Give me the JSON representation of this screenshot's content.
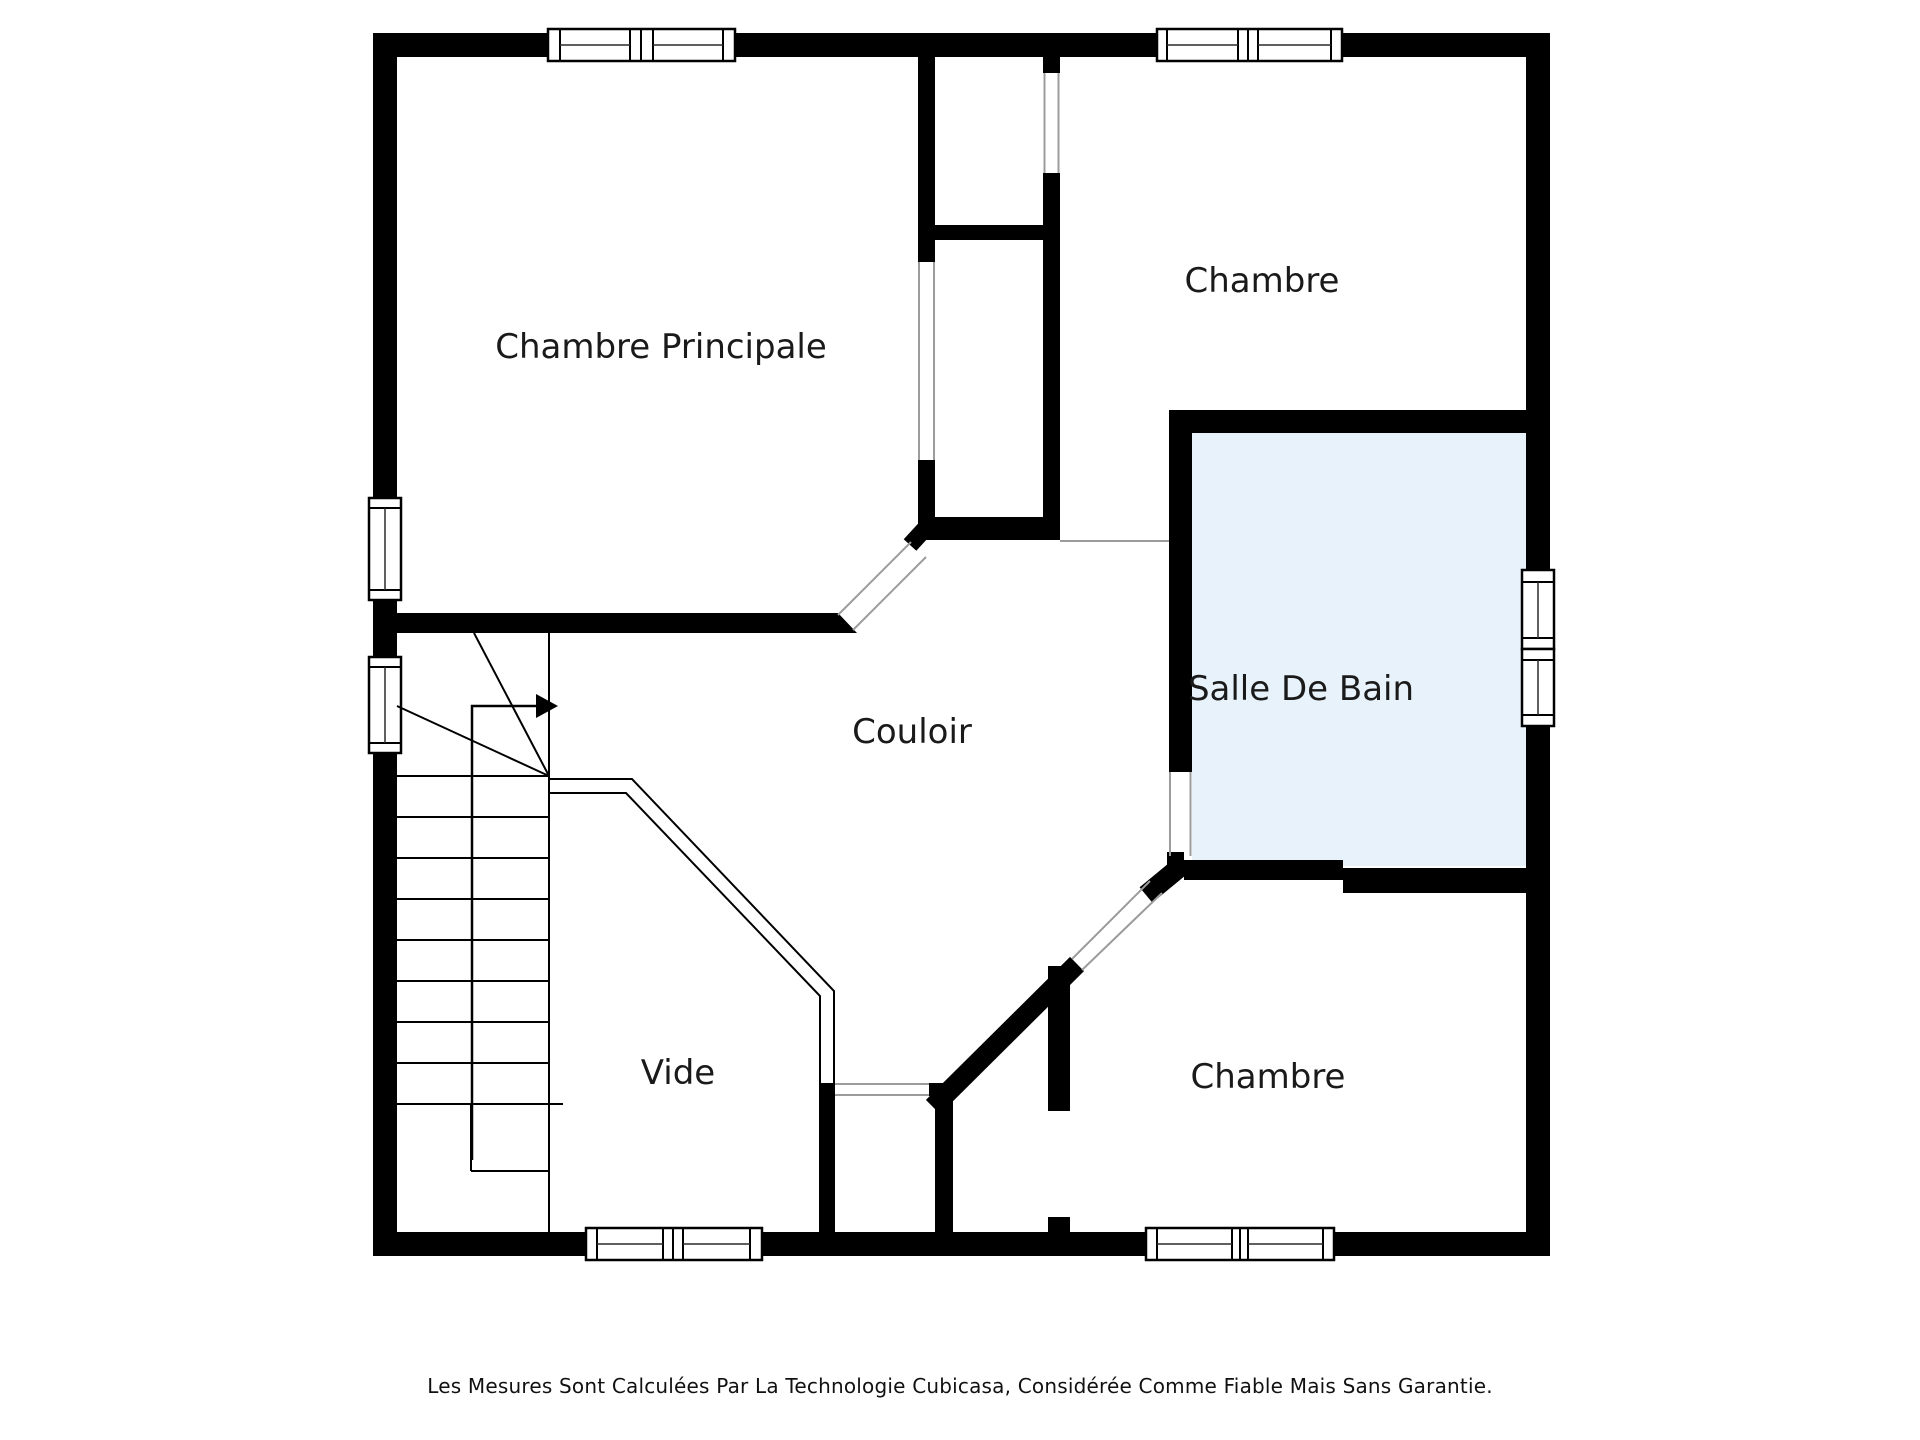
{
  "rooms": {
    "chambre_principale": {
      "label": "Chambre Principale"
    },
    "chambre_haut": {
      "label": "Chambre"
    },
    "salle_de_bain": {
      "label": "Salle De Bain"
    },
    "couloir": {
      "label": "Couloir"
    },
    "vide": {
      "label": "Vide"
    },
    "chambre_bas": {
      "label": "Chambre"
    }
  },
  "footer": {
    "disclaimer": "Les Mesures Sont Calculées Par La Technologie Cubicasa, Considérée Comme Fiable Mais Sans Garantie."
  },
  "colors": {
    "background": "#FFFFFF",
    "wall": "#000000",
    "bathroom_fill": "#E8F2FB",
    "opening_line": "#9C9C9C",
    "text": "#1A1A1A"
  }
}
